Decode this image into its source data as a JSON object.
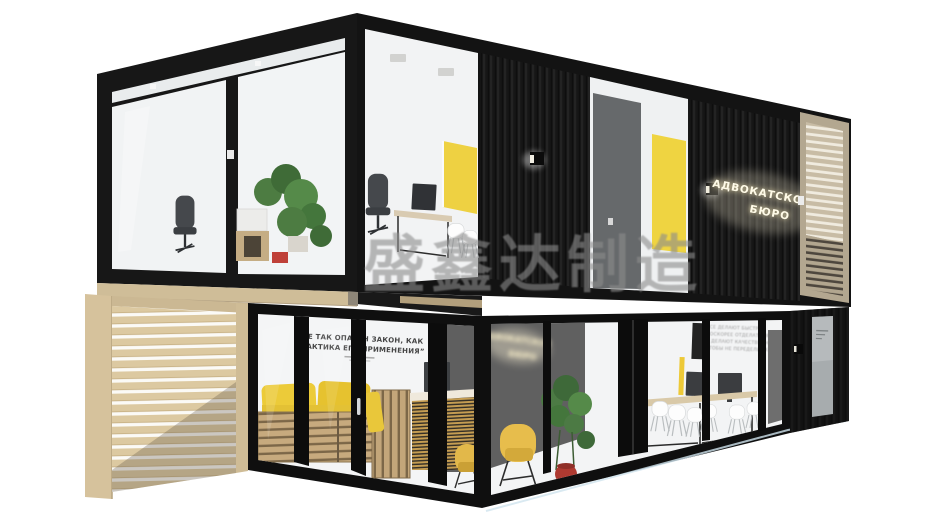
{
  "image": {
    "description": "3D render of a two-storey black shipping-container office building with glass facades, yellow doors and furniture, light wood slat screens, on a white background",
    "background_color": "#ffffff"
  },
  "watermark": {
    "text": "盛鑫达制造",
    "color": "#8c8c8c"
  },
  "building": {
    "sign": {
      "line1": "АДВОКАТСКОЕ",
      "line2": "БЮРО"
    },
    "interior_sign": {
      "line1": "АДВОКАТСКОЕ",
      "line2": "БЮРО"
    },
    "quote": {
      "line1": "“НЕ ТАК ОПАСЕН ЗАКОН, КАК",
      "line2": "ПРАКТИКА ЕГО ПРИМЕНЕНИЯ”"
    },
    "wall_text": {
      "line1": "ВСЕ ДЕЛАЮТ БЫСТРО,",
      "line2": "ПОСКОРЕЕ ОТДЕЛАТЬСЯ ОТ ДЕЛА,",
      "line3": "И ДЕЛАЮТ КАЧЕСТВЕННО,",
      "line4": "ЧТОБЫ НЕ ПЕРЕДЕЛЫВАТЬ"
    },
    "colors": {
      "container_black": "#141414",
      "accent_yellow": "#eecf3a",
      "wood_light": "#d7c5a0",
      "wood_gray": "#b3a790",
      "interior_gray": "#5f5f5f"
    }
  }
}
